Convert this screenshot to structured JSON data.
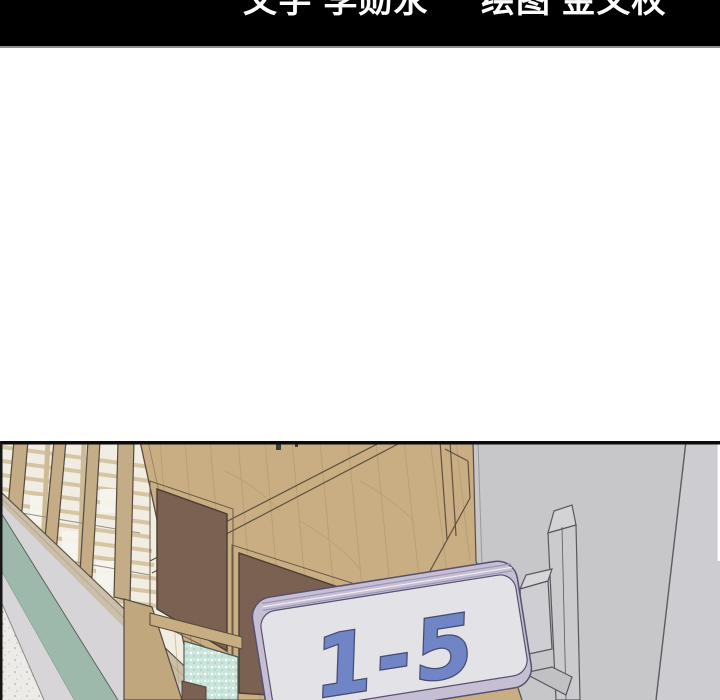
{
  "credits_bar": {
    "writer_credit": "文字 李勋永",
    "artist_credit": "绘图 金义权",
    "bar_color": "#000000",
    "text_color": "#fefefe"
  },
  "panel": {
    "sign": {
      "label": "1-5",
      "text_color": "#7085c6",
      "face_color": "#e3e2e6",
      "rim_color": "#c6bfd4",
      "bracket_color": "#cbcacd"
    },
    "colors": {
      "wall_gray": "#c7c6c9",
      "wall_gray_far": "#cdccd0",
      "wood": "#c9ae83",
      "wood_frame": "#c3ac86",
      "door_panel_brown": "#7b6152",
      "stripe_teal": "#9cb9ac",
      "frosted_glass": "#c9e4da",
      "floor": "#edebe7",
      "window_light": "#f1ede3",
      "sill_tan": "#cbbfa9",
      "outline": "#564a3b"
    }
  }
}
